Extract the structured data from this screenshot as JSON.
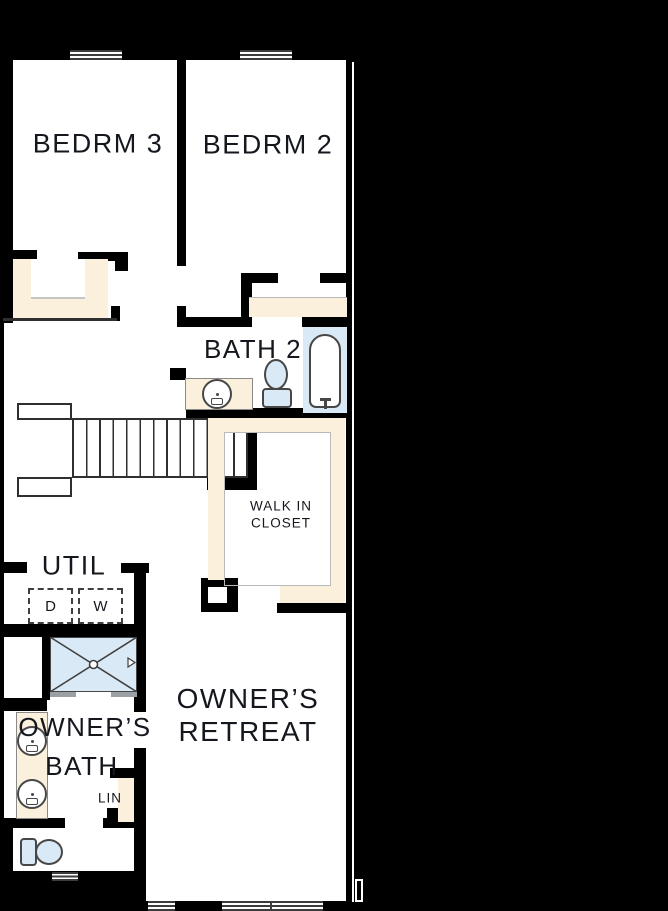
{
  "colors": {
    "wall": "#000000",
    "floor": "#ffffff",
    "casework": "#faf0dc",
    "fixture": "#d9eaf6",
    "ink": "#14171d"
  },
  "rooms": {
    "bedrm3": {
      "label": "BEDRM 3"
    },
    "bedrm2": {
      "label": "BEDRM 2"
    },
    "bath2": {
      "label": "BATH 2"
    },
    "walkin_closet": {
      "line1": "WALK IN",
      "line2": "CLOSET"
    },
    "util": {
      "label": "UTIL"
    },
    "owners_bath": {
      "line1": "OWNER’S",
      "line2": "BATH"
    },
    "owners_retreat": {
      "line1": "OWNER’S",
      "line2": "RETREAT"
    },
    "linen": {
      "label": "LIN"
    }
  },
  "appliances": {
    "dryer_label": "D",
    "washer_label": "W"
  },
  "fixtures": {
    "shower": "shower-pan-with-x",
    "bathtub": "bathtub",
    "toilet_count": 2,
    "sink_count": 3,
    "window_count": 5,
    "staircase": "staircase"
  }
}
